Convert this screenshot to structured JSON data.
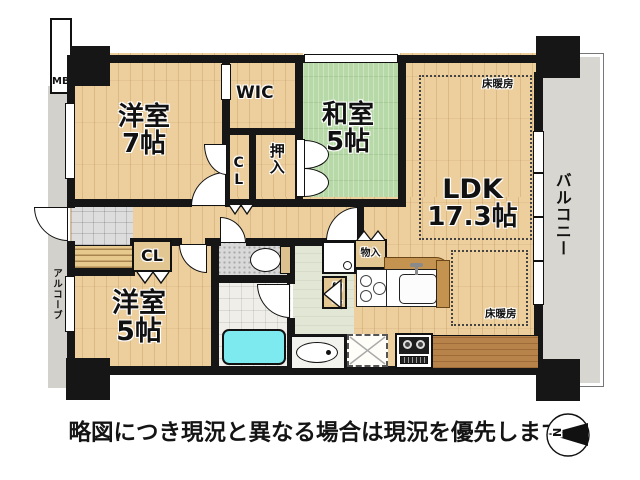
{
  "caption": "略図につき現況と異なる場合は現況を優先します",
  "compass": {
    "north": "N"
  },
  "exterior": {
    "balcony": "バルコニー",
    "alcove": "アルコーブ",
    "meter_box": "MB"
  },
  "rooms": {
    "western7": {
      "name": "洋室",
      "size": "7帖"
    },
    "wic": {
      "label": "WIC"
    },
    "closet_upper": {
      "label": "CL"
    },
    "oshiire": {
      "label": "押入"
    },
    "japanese5": {
      "name": "和室",
      "size": "5帖"
    },
    "ldk": {
      "name": "LDK",
      "size": "17.3帖"
    },
    "closet_lower": {
      "label": "CL"
    },
    "western5": {
      "name": "洋室",
      "size": "5帖"
    }
  },
  "features": {
    "storage_upper": "物入",
    "storage_lower": "物入",
    "floor_heating_upper": "床暖房",
    "floor_heating_lower": "床暖房"
  },
  "colors": {
    "wood": "#edcf9e",
    "tatami": "#b7d9a7",
    "wall": "#161616",
    "balcony": "#d8d6d0",
    "bathtub": "#7deaf0",
    "counter": "#c3934f"
  }
}
